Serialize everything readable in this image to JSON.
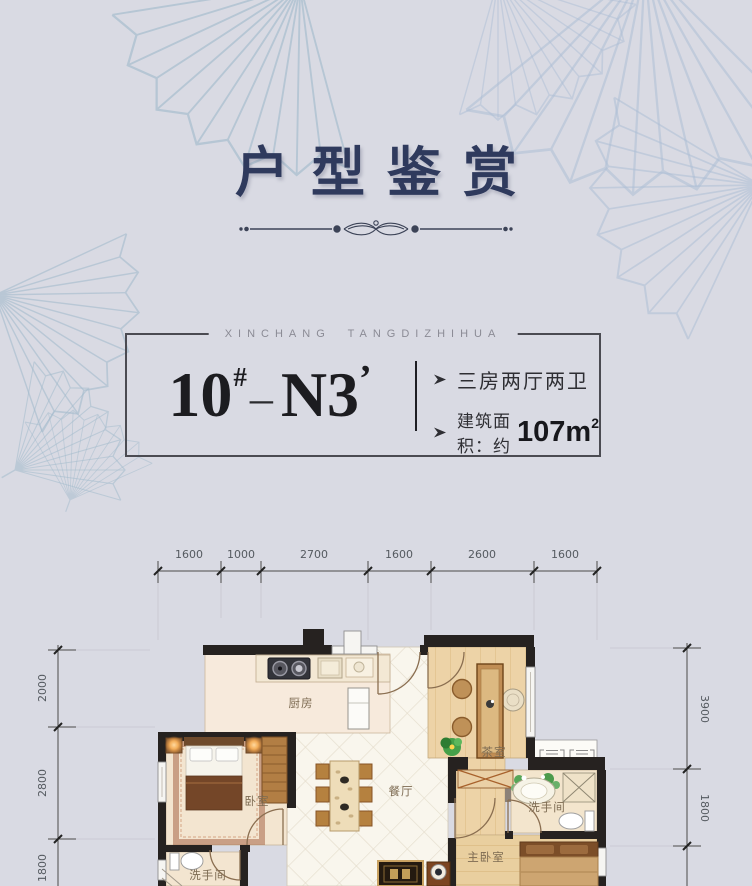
{
  "header": {
    "title": "户型鉴赏"
  },
  "card": {
    "brand": "XINCHANG TANGDIZHIHUA",
    "unit": {
      "block": "10",
      "hash": "#",
      "dash": "–",
      "type": "N3",
      "prime": "’"
    },
    "feature1": {
      "text": "三房两厅两卫"
    },
    "feature2": {
      "prefix": "建筑面积：约",
      "value": "107m",
      "sup": "2"
    }
  },
  "floorplan": {
    "dims_top": [
      "1600",
      "1000",
      "2700",
      "1600",
      "2600",
      "1600"
    ],
    "dims_left": [
      "2000",
      "2800",
      "1800"
    ],
    "dims_right": [
      "3900",
      "1800"
    ],
    "rooms": {
      "kitchen": "厨房",
      "bedroom": "卧室",
      "dining": "餐厅",
      "tea_room": "茶室",
      "bath_right": "洗手间",
      "bath_left": "洗手间",
      "master": "主卧室"
    }
  },
  "colors": {
    "background": "#d9dae3",
    "title": "#2f3a5d",
    "wall": "#262220",
    "accent_text": "#17171c"
  }
}
